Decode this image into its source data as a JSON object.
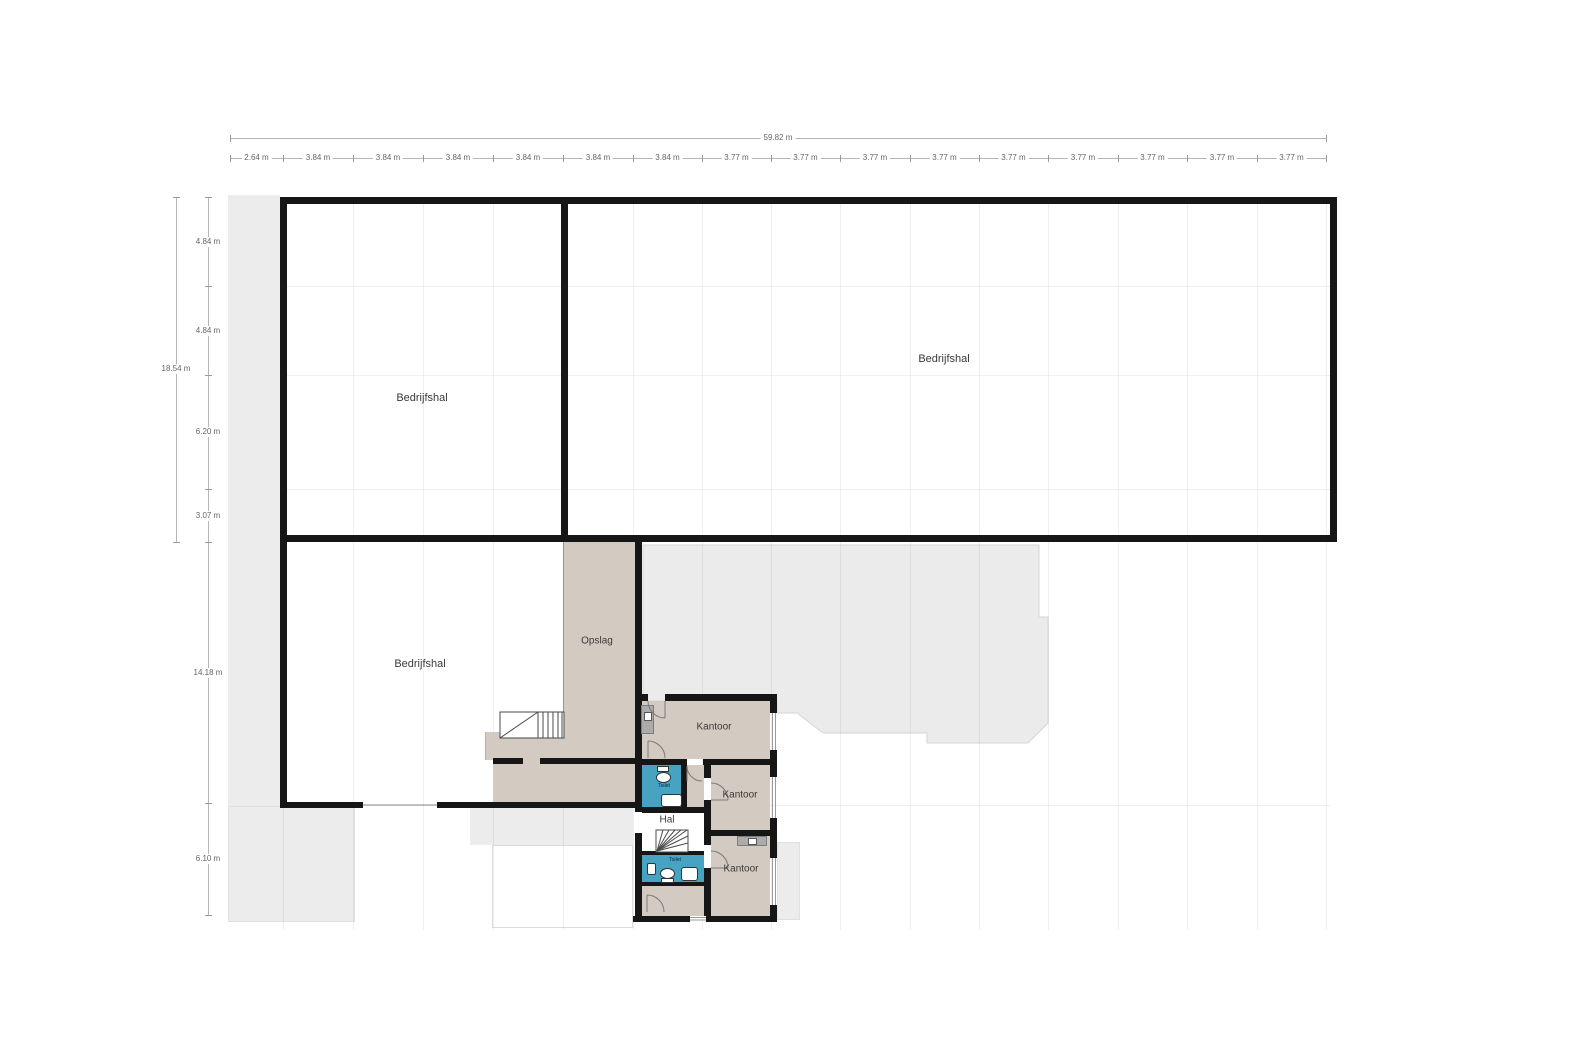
{
  "dimensions": {
    "top_total": "59.82 m",
    "top_segments": [
      "2.64 m",
      "3.84 m",
      "3.84 m",
      "3.84 m",
      "3.84 m",
      "3.84 m",
      "3.84 m",
      "3.77 m",
      "3.77 m",
      "3.77 m",
      "3.77 m",
      "3.77 m",
      "3.77 m",
      "3.77 m",
      "3.77 m",
      "3.77 m"
    ],
    "left_total": "18.54 m",
    "left_segments": [
      "4.84 m",
      "4.84 m",
      "6.20 m",
      "3.07 m",
      "14.18 m",
      "6.10 m"
    ]
  },
  "rooms": {
    "bedrijfshal_left": "Bedrijfshal",
    "bedrijfshal_right": "Bedrijfshal",
    "bedrijfshal_lower": "Bedrijfshal",
    "opslag": "Opslag",
    "kantoor_top": "Kantoor",
    "kantoor_middle": "Kantoor",
    "kantoor_bottom": "Kantoor",
    "hal": "Hal",
    "toilet_upper": "Toilet",
    "toilet_lower": "Toilet"
  },
  "colors": {
    "wall": "#161616",
    "room_beige": "#d3cac1",
    "room_blue": "#47a3c2",
    "backdrop_gray": "#ebebeb",
    "side_gray": "#ececec",
    "dim_text": "#666666"
  }
}
